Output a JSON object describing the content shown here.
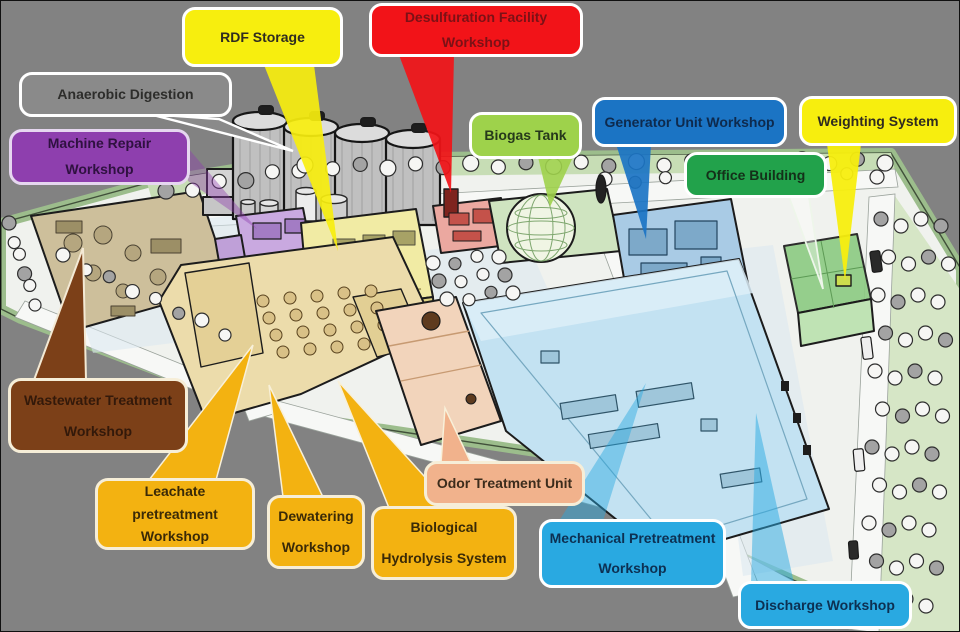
{
  "title": "Waste Treatment Plant Facility Layout Diagram",
  "callouts": [
    {
      "id": "rdf-storage",
      "label": "RDF Storage",
      "fill": "#f7ee0e",
      "border": "#ffffff",
      "text_color": "#2f2b20",
      "target": "rdf-storage-building"
    },
    {
      "id": "desulfuration",
      "label": "Desulfuration Facility Workshop",
      "fill": "#f21318",
      "border": "#ffffff",
      "text_color": "#7c1116",
      "target": "desulfuration-building"
    },
    {
      "id": "anaerobic-digestion",
      "label": "Anaerobic Digestion",
      "fill": "#8a8a8a",
      "border": "#ffffff",
      "text_color": "#2d2d2b",
      "target": "digester-silos"
    },
    {
      "id": "machine-repair",
      "label": "Machine Repair Workshop",
      "fill": "#8e3fae",
      "border": "#e6d7f0",
      "text_color": "#2f1140",
      "target": "machine-repair-building"
    },
    {
      "id": "biogas-tank",
      "label": "Biogas Tank",
      "fill": "#9ed24b",
      "border": "#ffffff",
      "text_color": "#26391b",
      "target": "biogas-dome"
    },
    {
      "id": "generator-unit",
      "label": "Generator Unit Workshop",
      "fill": "#1b74c4",
      "border": "#ffffff",
      "text_color": "#0e2a4d",
      "target": "generator-building"
    },
    {
      "id": "weighting-system",
      "label": "Weighting System",
      "fill": "#f7ee0e",
      "border": "#ffffff",
      "text_color": "#2f2b20",
      "target": "weighbridge"
    },
    {
      "id": "office-building",
      "label": "Office Building",
      "fill": "#22a24b",
      "border": "#ffffff",
      "text_color": "#143019",
      "target": "office-building"
    },
    {
      "id": "wastewater",
      "label": "Wastewater Treatment Workshop",
      "fill": "#7c4018",
      "border": "#f6eed8",
      "text_color": "#33190a",
      "target": "wastewater-basins"
    },
    {
      "id": "leachate",
      "label": "Leachate pretreatment Workshop",
      "fill": "#f3b211",
      "border": "#f6eed8",
      "text_color": "#3a2a07",
      "target": "pretreatment-complex"
    },
    {
      "id": "dewatering",
      "label": "Dewatering Workshop",
      "fill": "#f3b211",
      "border": "#f6eed8",
      "text_color": "#3a2a07",
      "target": "pretreatment-complex"
    },
    {
      "id": "biological-hydrolysis",
      "label": "Biological Hydrolysis System",
      "fill": "#f3b211",
      "border": "#f6eed8",
      "text_color": "#3a2a07",
      "target": "pretreatment-complex"
    },
    {
      "id": "odor-treatment",
      "label": "Odor Treatment Unit",
      "fill": "#f1b28c",
      "border": "#f6eed8",
      "text_color": "#3c2c1c",
      "target": "odor-building"
    },
    {
      "id": "mechanical-pretreatment",
      "label": "Mechanical Pretreatment Workshop",
      "fill": "#29a9e1",
      "border": "#ffffff",
      "text_color": "#0d3052",
      "target": "mechanical-building"
    },
    {
      "id": "discharge",
      "label": "Discharge Workshop",
      "fill": "#29a9e1",
      "border": "#ffffff",
      "text_color": "#0d3052",
      "target": "mechanical-building"
    }
  ],
  "illustration": {
    "buildings": [
      {
        "id": "wastewater-basins",
        "color": "#cdbf9b"
      },
      {
        "id": "machine-repair-building",
        "color": "#c9a9e0"
      },
      {
        "id": "rdf-storage-building",
        "color": "#f1eba4"
      },
      {
        "id": "pretreatment-complex",
        "color": "#ecdcab"
      },
      {
        "id": "desulfuration-building",
        "color": "#eba8a0"
      },
      {
        "id": "biogas-dome",
        "color": "#f0f5e4"
      },
      {
        "id": "generator-building",
        "color": "#a9cbe5"
      },
      {
        "id": "office-building",
        "color": "#8ecb84"
      },
      {
        "id": "weighbridge",
        "color": "#cddd4e"
      },
      {
        "id": "mechanical-building",
        "color": "#c3e2f2"
      },
      {
        "id": "odor-building",
        "color": "#f2d4bb"
      }
    ],
    "scenery": {
      "background": "#828282",
      "site_ground": "#f0f2ee",
      "grass_edge": "#9cbd8c",
      "grass_strip": "#c7ddb5",
      "road": "#f7f8f6",
      "pavement_tint": "#dbe7f0",
      "tree_light": "#f6f6f4",
      "tree_dark": "#a3a3a3",
      "silo_body": "#c0c0c0",
      "silo_top": "#dcdcdc"
    }
  }
}
